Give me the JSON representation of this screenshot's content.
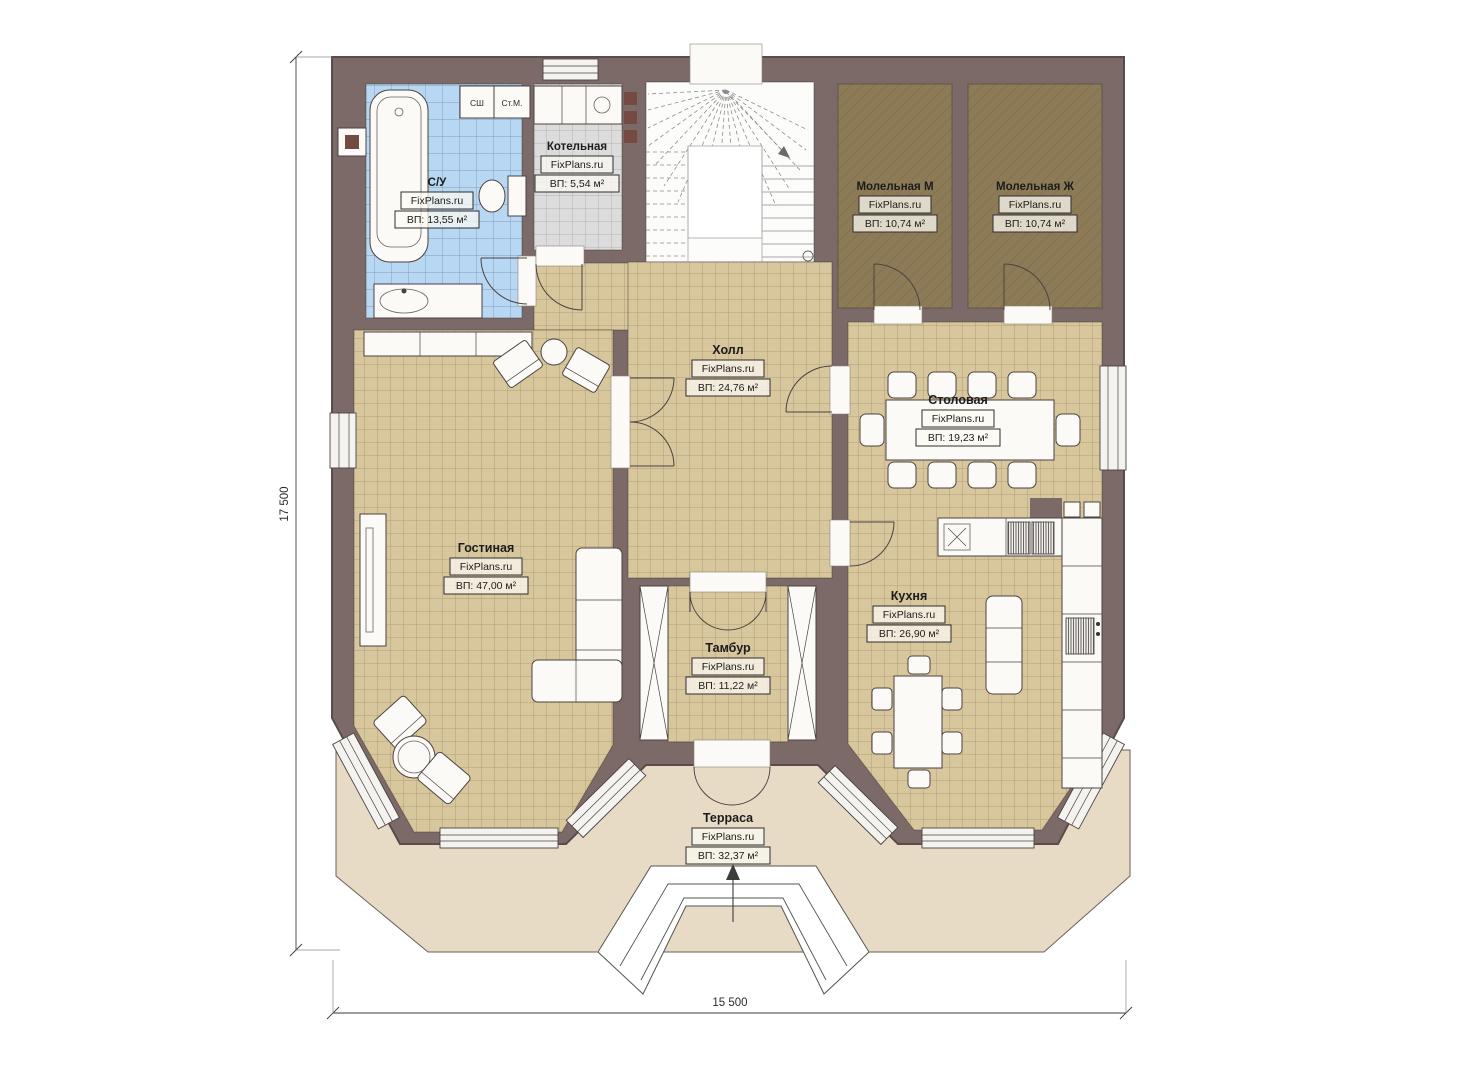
{
  "plan": {
    "brand": "FixPlans.ru",
    "dimensions": {
      "height_label": "17 500",
      "width_label": "15 500"
    },
    "rooms": [
      {
        "name": "С/У",
        "area": "ВП: 13,55 м²"
      },
      {
        "name": "Котельная",
        "area": "ВП: 5,54 м²"
      },
      {
        "name": "Холл",
        "area": "ВП: 24,76 м²"
      },
      {
        "name": "Молельная М",
        "area": "ВП: 10,74 м²"
      },
      {
        "name": "Молельная Ж",
        "area": "ВП: 10,74 м²"
      },
      {
        "name": "Столовая",
        "area": "ВП: 19,23 м²"
      },
      {
        "name": "Гостиная",
        "area": "ВП: 47,00 м²"
      },
      {
        "name": "Тамбур",
        "area": "ВП: 11,22 м²"
      },
      {
        "name": "Кухня",
        "area": "ВП: 26,90 м²"
      },
      {
        "name": "Терраса",
        "area": "ВП: 32,37 м²"
      }
    ],
    "closets": {
      "drying": "СШ",
      "washer": "Ст.М."
    },
    "colors": {
      "wall": "#7b6a68",
      "floor_tile": "#d8c69d",
      "floor_grid": "#a8946d",
      "bath_tile": "#b7d7f3",
      "bath_grid": "#7e9cba",
      "boiler_tile": "#dcdcdc",
      "boiler_grid": "#a9a9a9",
      "prayer_floor": "#8d7b57",
      "terrace": "#e7dbc6"
    }
  }
}
